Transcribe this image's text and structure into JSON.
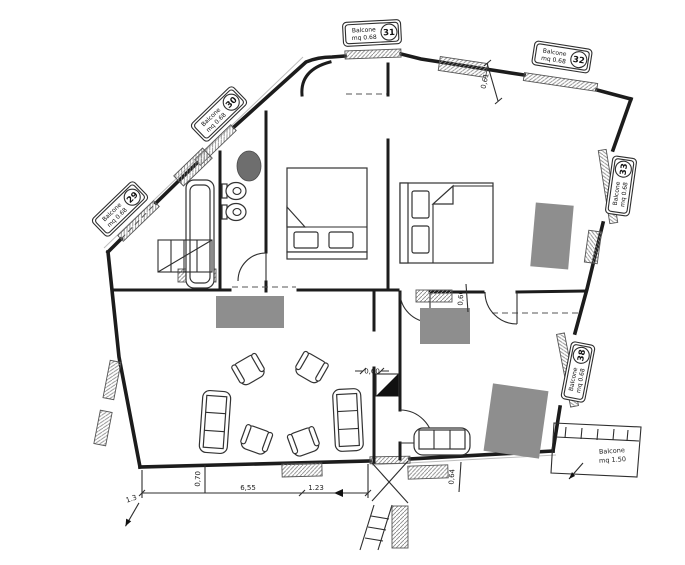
{
  "balconies": {
    "b29": {
      "label": "Balcone",
      "area": "mq 0.68",
      "num": "29"
    },
    "b30": {
      "label": "Balcone",
      "area": "mq 0.68",
      "num": "30"
    },
    "b31": {
      "label": "Balcone",
      "area": "mq 0.68",
      "num": "31"
    },
    "b32": {
      "label": "Balcone",
      "area": "mq 0.68",
      "num": "32"
    },
    "b33": {
      "label": "Balcone",
      "area": "mq 0.68",
      "num": "33"
    },
    "b38": {
      "label": "Balcone",
      "area": "mq 0.68",
      "num": "38"
    }
  },
  "balcony_note": {
    "label": "Balcone",
    "area": "mq 1.50"
  },
  "dimensions": {
    "top_right_height": "0,61",
    "mid_right_width": "0,60",
    "corridor_width": "0,60",
    "lower_right_width": "0,64",
    "lower_left_width": "0,70",
    "bottom_length": "6,55",
    "bottom_offset": "1.23",
    "bottom_corner": "1.3"
  },
  "colors": {
    "wall": "#1c1c1c",
    "cabinet_gray": "#8e8e8e",
    "basin_gray": "#6e6e6e"
  }
}
